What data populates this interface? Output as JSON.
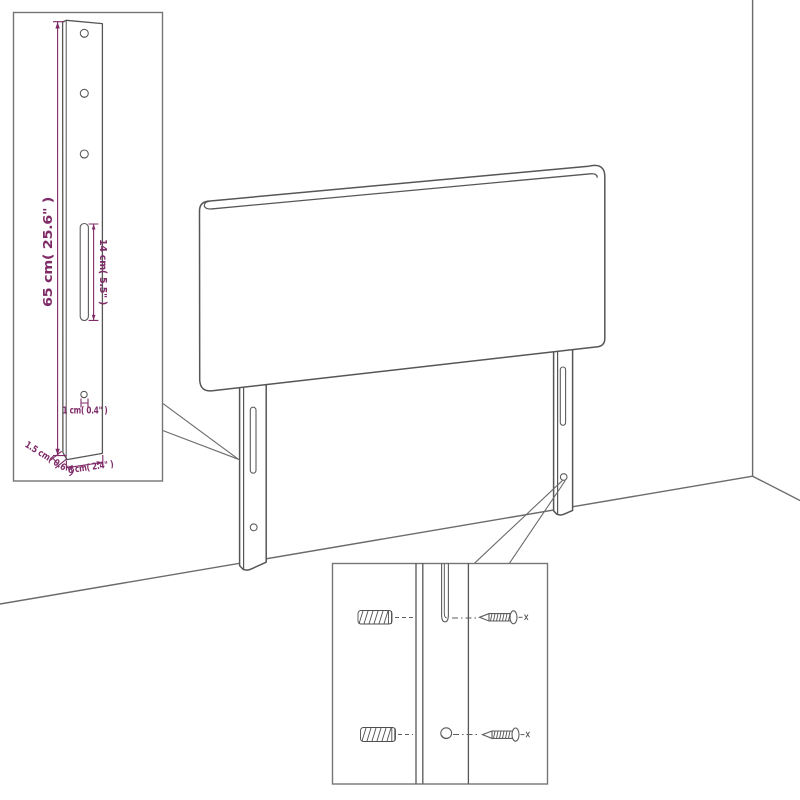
{
  "diagram": {
    "kind": "headboard wall-mounting dimension illustration",
    "colors": {
      "background": "#ffffff",
      "drawing_line": "#565656",
      "wall_line": "#6b6b6b",
      "inset_border": "#757575",
      "dimension": "#7e2b68"
    },
    "dimensions": {
      "leg_height": "65 cm( 25.6\" )",
      "slot_length": "14 cm( 5.5\" )",
      "hole_width": "1 cm( 0.4\" )",
      "leg_depth": "1.5 cm( 0.6\" )",
      "leg_width": "6 cm( 2.4\" )"
    }
  }
}
